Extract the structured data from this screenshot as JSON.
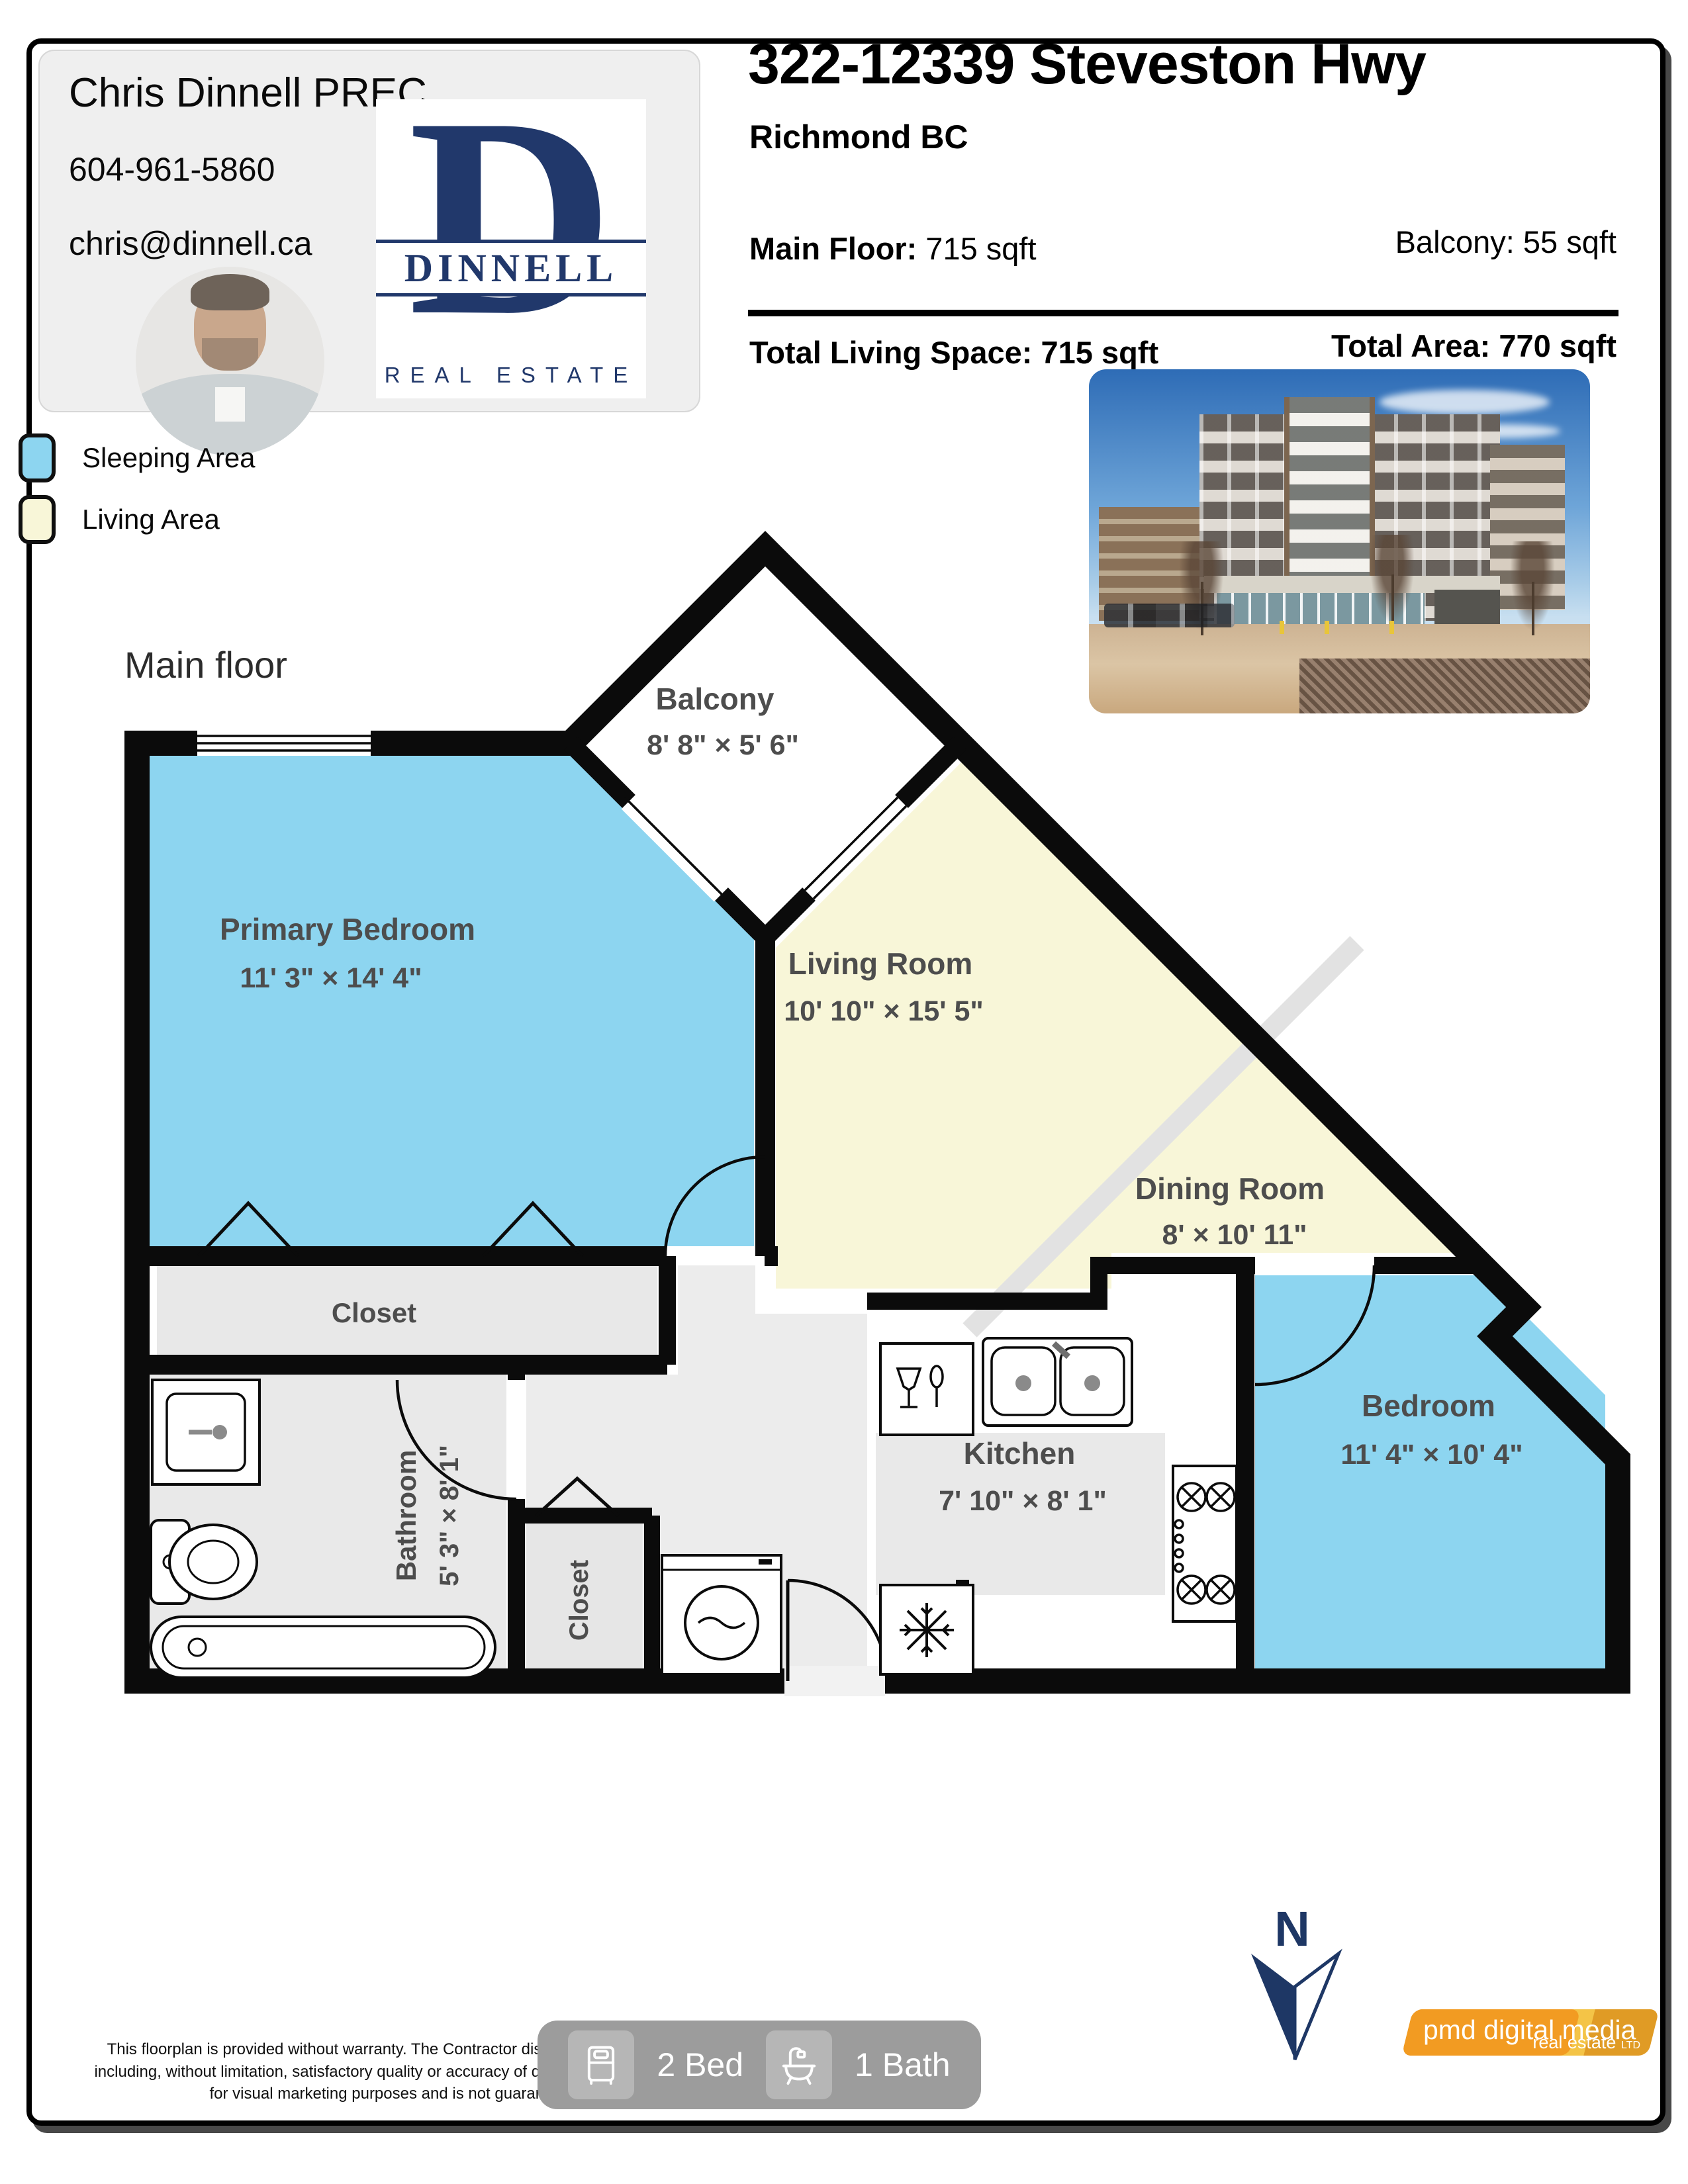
{
  "agent": {
    "name": "Chris Dinnell PREC",
    "phone": "604-961-5860",
    "email": "chris@dinnell.ca",
    "logo": {
      "initial": "D",
      "name": "DINNELL",
      "tagline": "REAL ESTATE",
      "color": "#21386b"
    }
  },
  "header": {
    "title": "322-12339 Steveston Hwy",
    "city": "Richmond BC",
    "stats": {
      "main_floor_label": "Main Floor:",
      "main_floor_value": " 715 sqft",
      "balcony": "Balcony: 55 sqft",
      "total_living": "Total Living Space: 715 sqft",
      "total_area": "Total Area: 770 sqft"
    }
  },
  "legend": {
    "items": [
      {
        "label": "Sleeping Area",
        "color": "#8dd5f0"
      },
      {
        "label": "Living Area",
        "color": "#f8f6d8"
      }
    ]
  },
  "plan": {
    "floor_label": "Main floor",
    "compass_label": "N",
    "rooms": {
      "balcony": {
        "name": "Balcony",
        "dims": "8' 8\" × 5' 6\""
      },
      "primary_bedroom": {
        "name": "Primary Bedroom",
        "dims": "11' 3\" × 14' 4\""
      },
      "living_room": {
        "name": "Living Room",
        "dims": "10' 10\" × 15' 5\""
      },
      "dining_room": {
        "name": "Dining Room",
        "dims": "8' × 10' 11\""
      },
      "bedroom": {
        "name": "Bedroom",
        "dims": "11' 4\" × 10' 4\""
      },
      "kitchen": {
        "name": "Kitchen",
        "dims": "7' 10\" × 8' 1\""
      },
      "bathroom": {
        "name": "Bathroom",
        "dims": "5' 3\" × 8' 1\""
      },
      "closet_primary": "Closet",
      "closet_hall": "Closet"
    }
  },
  "footer": {
    "disclaimer": "This floorplan is provided without warranty. The Contractor disclaims any warranty including, without limitation, satisfactory quality or accuracy of dimension. Floorplan is for visual marketing purposes and is not guaranteed.",
    "badges": {
      "beds": "2 Bed",
      "baths": "1 Bath"
    },
    "branding": {
      "name": "pmd digital media",
      "sub": "real estate",
      "suffix": "LTD"
    }
  }
}
